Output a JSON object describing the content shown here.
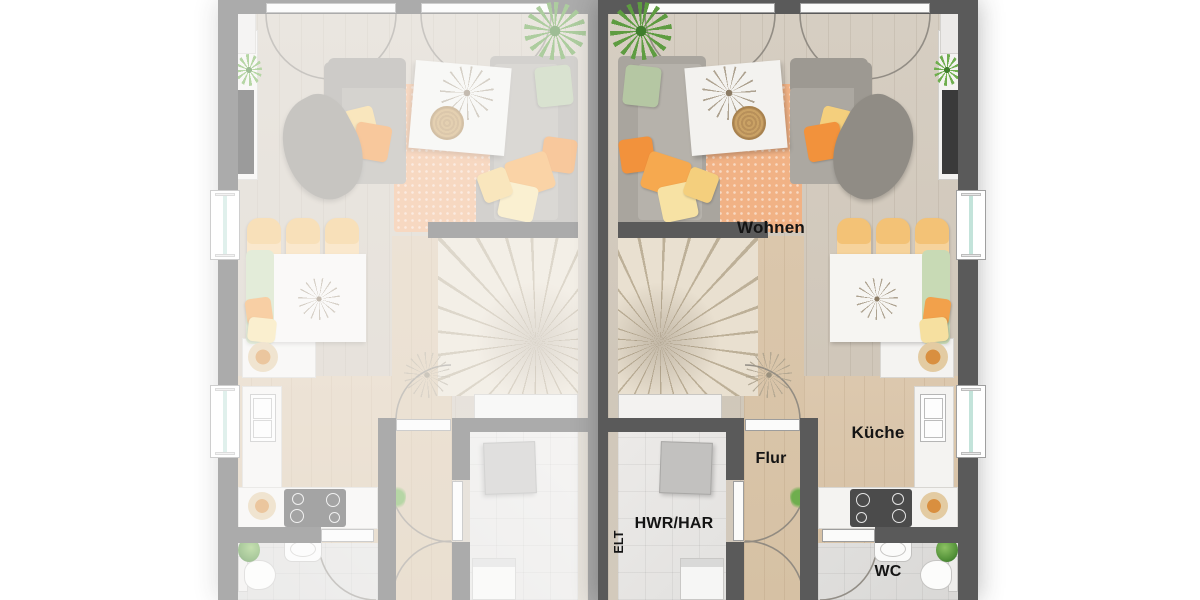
{
  "image_type": "residential floor plan, ground floor of a semi-detached duplex; left unit faded, right unit highlighted",
  "rooms": {
    "wohnen": "Wohnen",
    "kueche": "Küche",
    "flur": "Flur",
    "hwr": "HWR/HAR",
    "elt": "ELT",
    "wc": "WC"
  },
  "units": {
    "left": {
      "style": "faded mirror copy",
      "labeled": false
    },
    "right": {
      "style": "full color",
      "labeled": true
    }
  },
  "colors": {
    "background": "#ffffff",
    "wall": "#5a5a5a",
    "floor_living": "#d2c9bc",
    "floor_hall_kitchen": "#d8c3a7",
    "floor_utility": "#e6e5e3",
    "floor_wc": "#dcdbd9",
    "rug_orange": "#f1b285",
    "sofa_gray": "#a9a59e",
    "pillow_orange": "#f2923c",
    "pillow_yellow": "#f4cf7d",
    "pillow_green": "#b5c7a3",
    "chair_yellow": "#f3c276",
    "bench_green": "#c8dab5",
    "window_glass": "#c3e3da"
  }
}
